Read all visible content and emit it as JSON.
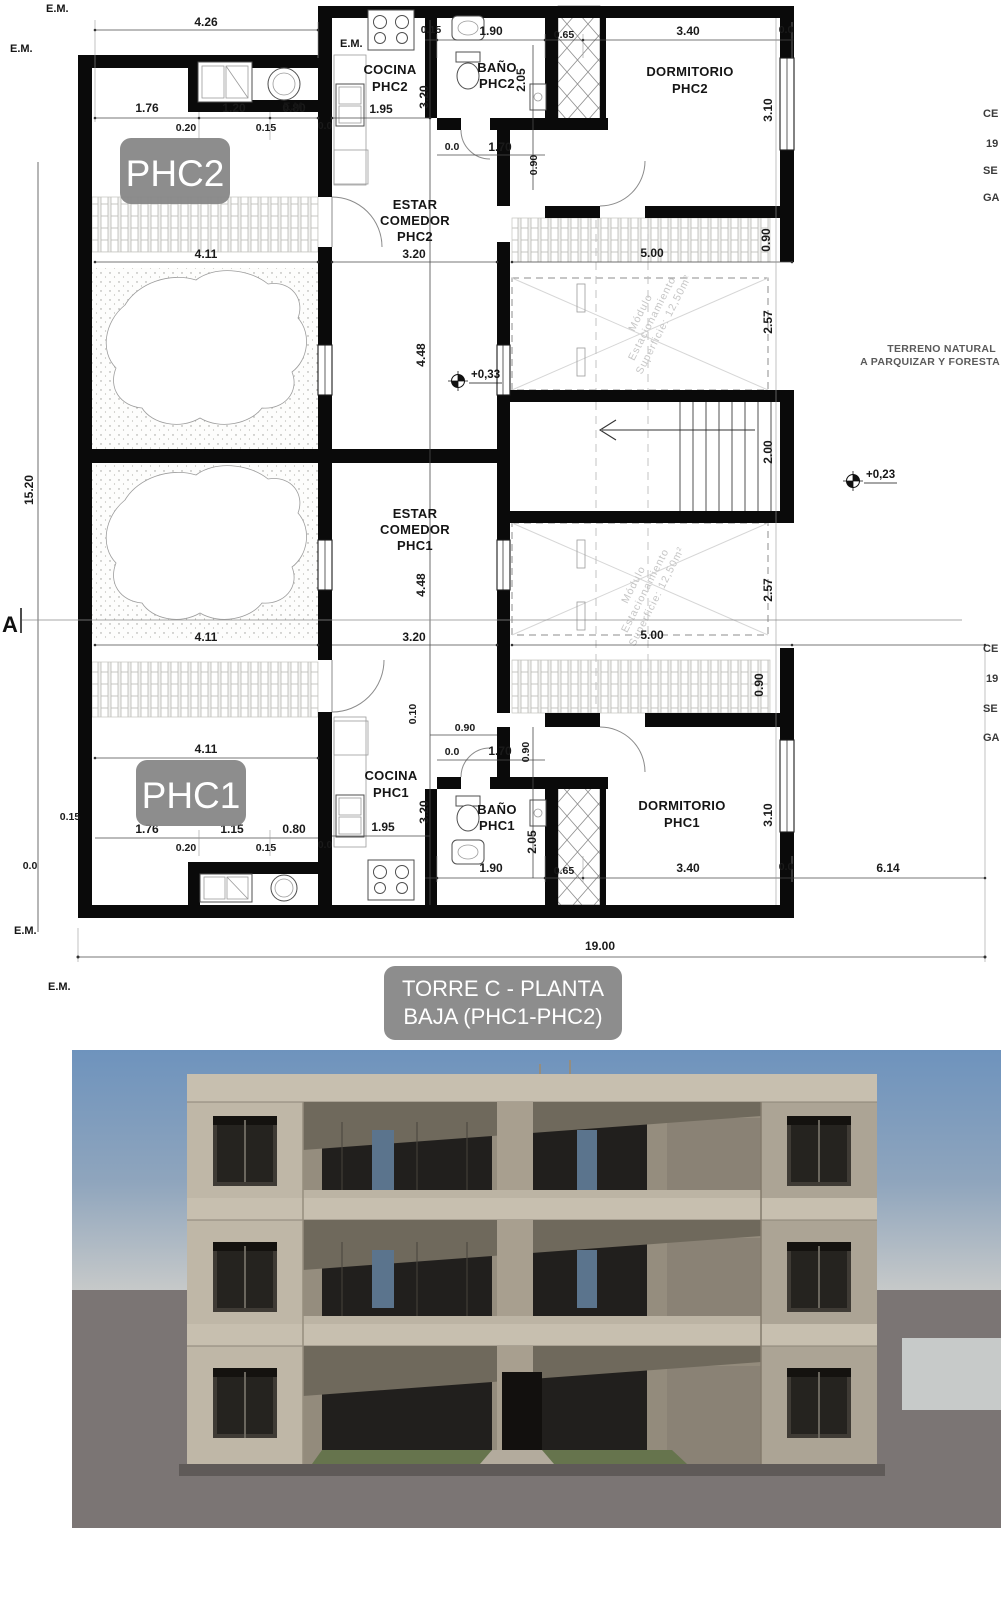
{
  "plan": {
    "title_line1": "TORRE C - PLANTA",
    "title_line2": "BAJA (PHC1-PHC2)",
    "unit_badges": {
      "phc2": "PHC2",
      "phc1": "PHC1"
    },
    "rooms": {
      "cocina_phc2": [
        "COCINA",
        "PHC2"
      ],
      "bano_phc2": [
        "BAÑO",
        "PHC2"
      ],
      "dormitorio_phc2": [
        "DORMITORIO",
        "PHC2"
      ],
      "estar_phc2": [
        "ESTAR",
        "COMEDOR",
        "PHC2"
      ],
      "estar_phc1": [
        "ESTAR",
        "COMEDOR",
        "PHC1"
      ],
      "cocina_phc1": [
        "COCINA",
        "PHC1"
      ],
      "bano_phc1": [
        "BAÑO",
        "PHC1"
      ],
      "dormitorio_phc1": [
        "DORMITORIO",
        "PHC1"
      ]
    },
    "parking_label": [
      "Módulo",
      "Estacionamiento",
      "Superficie: 12,50m²"
    ],
    "levels": {
      "l033": "+0,33",
      "l023": "+0,23"
    },
    "notes": {
      "em": "E.M.",
      "section_a": "A",
      "terreno1": "TERRENO NATURAL",
      "terreno2": "A PARQUIZAR Y FORESTA",
      "edge1": "CE",
      "edge2": "19",
      "edge3": "SE",
      "edge4": "GA"
    },
    "dims": {
      "d426": "4.26",
      "d176": "1.76",
      "d120": "1.20",
      "d115": "1.15",
      "d080": "0.80",
      "d020": "0.20",
      "d015": "0.15",
      "d195": "1.95",
      "d320": "3.20",
      "d190": "1.90",
      "d065": "0.65",
      "d340": "3.40",
      "d310": "3.10",
      "d205": "2.05",
      "d090": "0.90",
      "d170": "1.70",
      "d411": "4.11",
      "d500": "5.00",
      "d448": "4.48",
      "d257": "2.57",
      "d200": "2.00",
      "d010": "0.10",
      "d614": "6.14",
      "d1900": "19.00",
      "d1520": "15.20",
      "d00": "0.0"
    }
  },
  "colors": {
    "wall": "#0a0a0a",
    "dim_text": "#1a1a1a",
    "badge_bg": "#878787",
    "badge_text": "#ffffff",
    "parking_text": "#c6c6c6",
    "sky_top": "#6e93bd",
    "sky_mid": "#8fa5bd",
    "horizon": "#c6c9c9",
    "ground": "#7b7574",
    "concrete_light": "#c7bfaf",
    "concrete": "#b7af9f",
    "concrete_dark": "#aca495",
    "recess": "#958d7e",
    "shadow": "#6f695c",
    "glass": "#211f1d",
    "frame": "#3f3b35",
    "grass": "#66744d"
  }
}
